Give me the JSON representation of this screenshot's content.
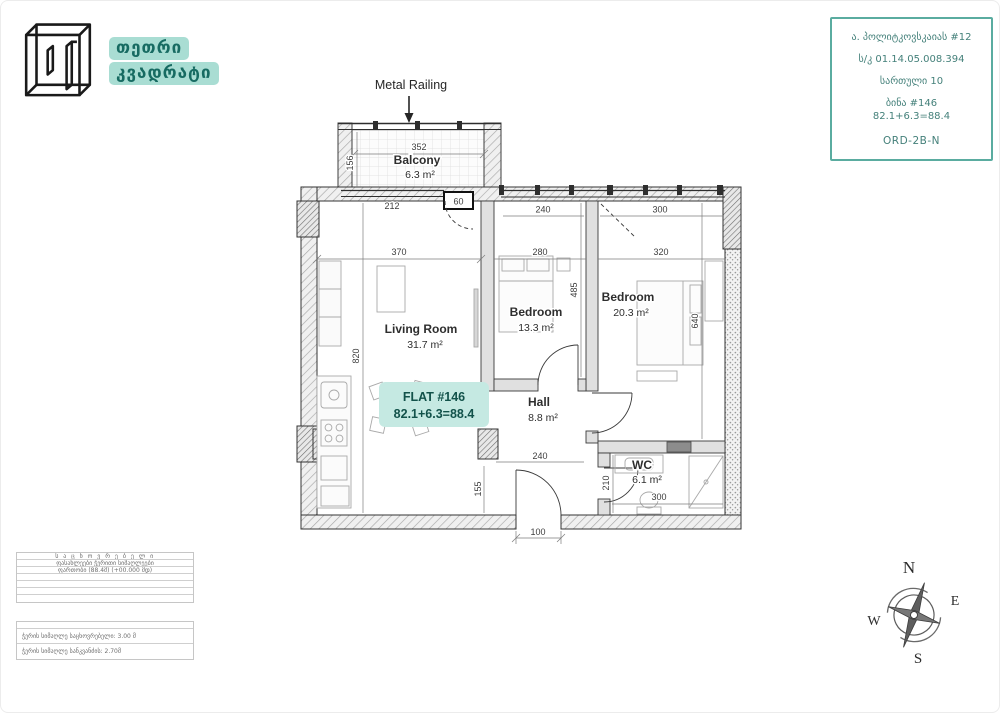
{
  "brand": {
    "name_line1": "თეთრი",
    "name_line2": "კვადრატი"
  },
  "info_card": {
    "address": "ა. პოლიტკოვსკაიას  #12",
    "cadastral": "ს/კ 01.14.05.008.394",
    "floor": "სართული 10",
    "flat": "ბინა #146",
    "area_sum": "82.1+6.3=88.4",
    "type_code": "ORD-2B-N"
  },
  "plan": {
    "metal_railing": "Metal Railing",
    "flat_box": {
      "title": "FLAT #146",
      "area": "82.1+6.3=88.4"
    },
    "rooms": {
      "balcony": {
        "name": "Balcony",
        "area": "6.3 m²"
      },
      "living": {
        "name": "Living Room",
        "area": "31.7 m²"
      },
      "bedroom1": {
        "name": "Bedroom",
        "area": "13.3 m²"
      },
      "bedroom2": {
        "name": "Bedroom",
        "area": "20.3 m²"
      },
      "hall": {
        "name": "Hall",
        "area": "8.8 m²"
      },
      "wc": {
        "name": "WC",
        "area": "6.1 m²"
      }
    },
    "dims": {
      "balcony_width": "352",
      "balcony_depth": "156",
      "balcony_wall": "212",
      "balcony_door": "60",
      "bed1_window": "240",
      "bed2_window": "300",
      "living_width": "370",
      "bed1_width": "280",
      "bed2_width": "320",
      "bed1_depth": "485",
      "living_depth": "820",
      "bed2_depth": "640",
      "hall_width": "240",
      "hall_niche": "155",
      "wc_depth": "210",
      "wc_width": "300",
      "entrance_width": "100"
    }
  },
  "legend": {
    "table1_rows": [
      "ს ა ც ხ ო ვ რ ე ბ ე ლ ი",
      "ფასახლეები ჭერითი სიმაღლეები",
      "ფართობი (88.4მ) (+00.000 მდ)",
      "",
      "",
      "",
      ""
    ],
    "table2_rows": [
      "",
      "ჭერის სიმაღლე საცხოვრებელი: 3.00 მ",
      "ჭერის სიმაღლე სანკვანძის: 2.70მ"
    ]
  },
  "compass": {
    "n": "N",
    "e": "E",
    "s": "S",
    "w": "W"
  },
  "colors": {
    "mint": "#a9ddd3",
    "teal_border": "#5aaca0",
    "teal_text": "#176b62",
    "flat_box_bg": "#c5e9e2"
  }
}
